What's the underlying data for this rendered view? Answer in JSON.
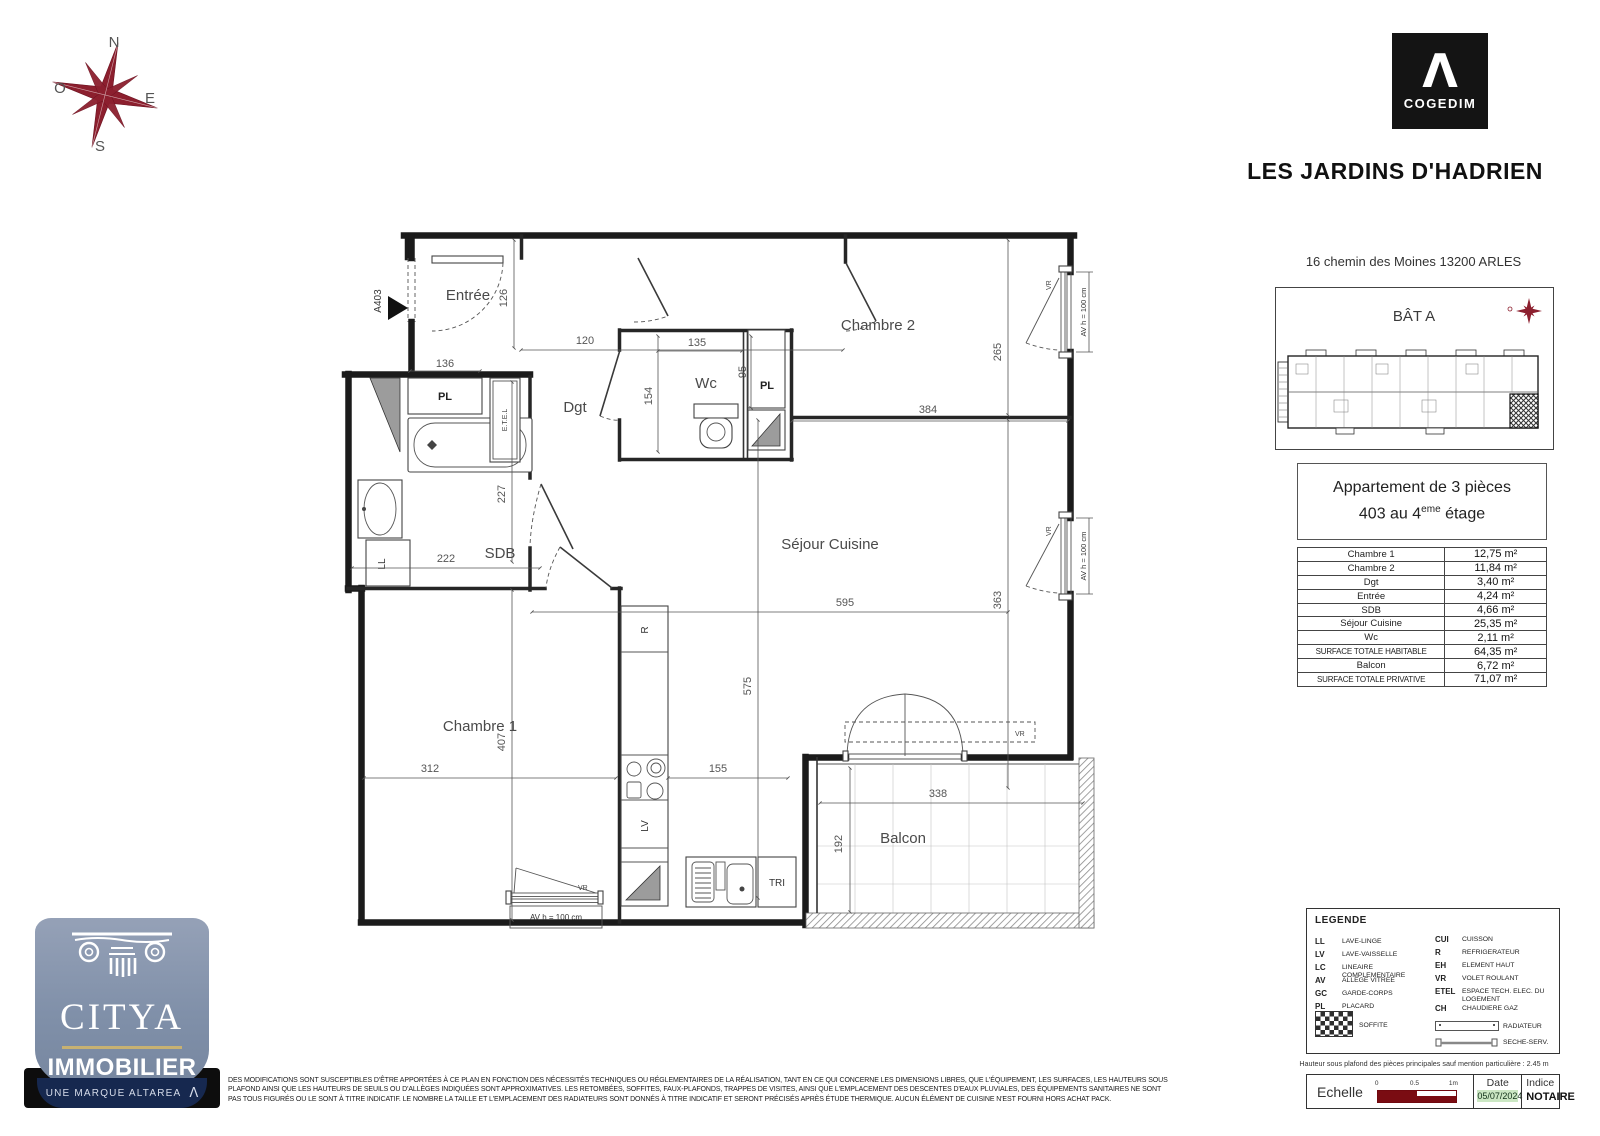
{
  "compass": {
    "n": "N",
    "o": "O",
    "e": "E",
    "s": "S"
  },
  "brand": {
    "logo_mark": "Λ",
    "logo_text": "COGEDIM",
    "title": "LES JARDINS D'HADRIEN"
  },
  "project": {
    "address": "16 chemin des Moines 13200 ARLES",
    "building": "BÂT A"
  },
  "apartment": {
    "line1": "Appartement de 3 pièces",
    "line2_prefix": "403 au 4",
    "line2_sup": "eme",
    "line2_suffix": " étage"
  },
  "surface_table": {
    "rows": [
      {
        "label": "Chambre 1",
        "value": "12,75 m²"
      },
      {
        "label": "Chambre 2",
        "value": "11,84 m²"
      },
      {
        "label": "Dgt",
        "value": "3,40 m²"
      },
      {
        "label": "Entrée",
        "value": "4,24 m²"
      },
      {
        "label": "SDB",
        "value": "4,66 m²"
      },
      {
        "label": "Séjour Cuisine",
        "value": "25,35 m²"
      },
      {
        "label": "Wc",
        "value": "2,11 m²"
      },
      {
        "label": "SURFACE TOTALE HABITABLE",
        "value": "64,35 m²"
      },
      {
        "label": "Balcon",
        "value": "6,72 m²"
      },
      {
        "label": "SURFACE TOTALE PRIVATIVE",
        "value": "71,07 m²"
      }
    ]
  },
  "plan": {
    "unit_ref": "A403",
    "rooms": {
      "entree": "Entrée",
      "chambre2": "Chambre 2",
      "wc": "Wc",
      "dgt": "Dgt",
      "sdb": "SDB",
      "sejour": "Séjour Cuisine",
      "chambre1": "Chambre 1",
      "balcon": "Balcon"
    },
    "equipment": {
      "pl": "PL",
      "etel": "E.T.E.L",
      "ll": "LL",
      "r": "R",
      "lv": "LV",
      "tri": "TRI",
      "vr": "VR"
    },
    "window_note": "AV h = 100 cm",
    "dims": {
      "entree_h": "126",
      "dgt_w": "120",
      "pl_sdb_w": "136",
      "wc_w": "135",
      "wc_h": "154",
      "pl_wc_h": "95",
      "ch2_h": "265",
      "ch2_w": "384",
      "sdb_h": "227",
      "sdb_w": "222",
      "sejour_w": "595",
      "sejour_h": "575",
      "sejour_right_h": "363",
      "ch1_h": "407",
      "ch1_w": "312",
      "kitchen_w": "155",
      "balcon_w": "338",
      "balcon_h": "192"
    }
  },
  "legend": {
    "title": "LEGENDE",
    "left": [
      {
        "code": "LL",
        "label": "LAVE-LINGE"
      },
      {
        "code": "LV",
        "label": "LAVE-VAISSELLE"
      },
      {
        "code": "LC",
        "label": "LINEAIRE COMPLEMENTAIRE"
      },
      {
        "code": "AV",
        "label": "ALLEGE VITREE"
      },
      {
        "code": "GC",
        "label": "GARDE-CORPS"
      },
      {
        "code": "PL",
        "label": "PLACARD"
      }
    ],
    "right": [
      {
        "code": "CUI",
        "label": "CUISSON"
      },
      {
        "code": "R",
        "label": "REFRIGERATEUR"
      },
      {
        "code": "EH",
        "label": "ELEMENT HAUT"
      },
      {
        "code": "VR",
        "label": "VOLET ROULANT"
      },
      {
        "code": "ETEL",
        "label": "ESPACE TECH. ELEC. DU LOGEMENT"
      },
      {
        "code": "CH",
        "label": "CHAUDIERE GAZ"
      }
    ],
    "soffite": "SOFFITE",
    "radiateur": "RADIATEUR",
    "seche": "SECHE-SERV."
  },
  "footer": {
    "ceiling_note": "Hauteur sous plafond des pièces principales sauf mention particulière : 2.45 m",
    "scale_label": "Echelle",
    "scale_ticks": [
      "0",
      "0.5",
      "1m"
    ],
    "date_label": "Date",
    "date_value": "05/07/2024",
    "index_label": "Indice",
    "index_value": "NOTAIRE",
    "disclaimer_1": "DES MODIFICATIONS SONT SUSCEPTIBLES D'ÊTRE APPORTÉES À CE PLAN EN FONCTION DES NÉCESSITÉS TECHNIQUES OU RÉGLEMENTAIRES DE LA RÉALISATION, TANT EN CE QUI CONCERNE LES DIMENSIONS LIBRES, QUE L'ÉQUIPEMENT, LES SURFACES, LES HAUTEURS SOUS",
    "disclaimer_2": "PLAFOND AINSI QUE LES HAUTEURS DE SEUILS OU D'ALLÈGES INDIQUÉES SONT APPROXIMATIVES. LES RETOMBÉES, SOFFITES, FAUX-PLAFONDS, TRAPPES DE VISITES, AINSI QUE L'EMPLACEMENT DES DESCENTES D'EAUX PLUVIALES, DES ÉQUIPEMENTS SANITAIRES NE SONT",
    "disclaimer_3": "PAS TOUS FIGURÉS OU LE SONT À TITRE INDICATIF. LE NOMBRE LA TAILLE ET L'EMPLACEMENT DES RADIATEURS SONT DONNÉS À TITRE INDICATIF ET SERONT PRÉCISÉS APRÈS ÉTUDE THERMIQUE. AUCUN ÉLÉMENT DE CUISINE N'EST FOURNI HORS ACHAT PACK."
  },
  "agency": {
    "name": "CITYA",
    "division": "IMMOBILIER",
    "tagline": "UNE MARQUE ALTAREA",
    "mark": "Λ"
  },
  "colors": {
    "accent_red": "#8c1f2e",
    "scale_red": "#7a0c12",
    "date_green": "#cbe7c3",
    "citya_blue": "#8090a9",
    "citya_navy": "#16284f",
    "citya_gold": "#c7b172"
  }
}
